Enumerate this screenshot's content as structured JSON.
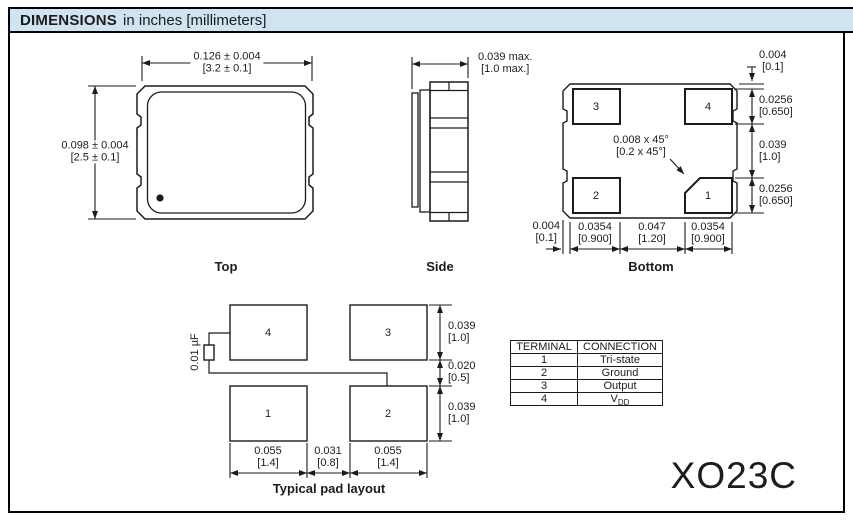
{
  "header": {
    "title_bold": "DIMENSIONS",
    "title_rest": "in inches [millimeters]"
  },
  "views": {
    "top": {
      "label": "Top",
      "width_dim": {
        "in": "0.126 ± 0.004",
        "mm": "[3.2 ± 0.1]"
      },
      "height_dim": {
        "in": "0.098 ± 0.004",
        "mm": "[2.5 ± 0.1]"
      }
    },
    "side": {
      "label": "Side",
      "height_dim": {
        "in": "0.039 max.",
        "mm": "[1.0 max.]"
      }
    },
    "bottom": {
      "label": "Bottom",
      "pads": [
        "3",
        "4",
        "2",
        "1"
      ],
      "chamfer_dim": {
        "in": "0.008 x 45°",
        "mm": "[0.2 x 45°]"
      },
      "right_dims": [
        {
          "in": "0.004",
          "mm": "[0.1]"
        },
        {
          "in": "0.0256",
          "mm": "[0.650]"
        },
        {
          "in": "0.039",
          "mm": "[1.0]"
        },
        {
          "in": "0.0256",
          "mm": "[0.650]"
        }
      ],
      "bottom_dims": [
        {
          "in": "0.004",
          "mm": "[0.1]"
        },
        {
          "in": "0.0354",
          "mm": "[0.900]"
        },
        {
          "in": "0.047",
          "mm": "[1.20]"
        },
        {
          "in": "0.0354",
          "mm": "[0.900]"
        }
      ]
    },
    "pad_layout": {
      "label": "Typical pad layout",
      "pads": [
        "4",
        "3",
        "1",
        "2"
      ],
      "capacitor_label": "0.01 µF",
      "right_dims": [
        {
          "in": "0.039",
          "mm": "[1.0]"
        },
        {
          "in": "0.020",
          "mm": "[0.5]"
        },
        {
          "in": "0.039",
          "mm": "[1.0]"
        }
      ],
      "bottom_dims": [
        {
          "in": "0.055",
          "mm": "[1.4]"
        },
        {
          "in": "0.031",
          "mm": "[0.8]"
        },
        {
          "in": "0.055",
          "mm": "[1.4]"
        }
      ]
    }
  },
  "terminal_table": {
    "headers": [
      "TERMINAL",
      "CONNECTION"
    ],
    "rows": [
      {
        "terminal": "1",
        "connection": "Tri-state"
      },
      {
        "terminal": "2",
        "connection": "Ground"
      },
      {
        "terminal": "3",
        "connection": "Output"
      },
      {
        "terminal": "4",
        "connection": "V",
        "connection_sub": "DD"
      }
    ]
  },
  "part_number": "XO23C",
  "colors": {
    "header_bg": "#cfe3f1",
    "line": "#1c1c1c"
  }
}
